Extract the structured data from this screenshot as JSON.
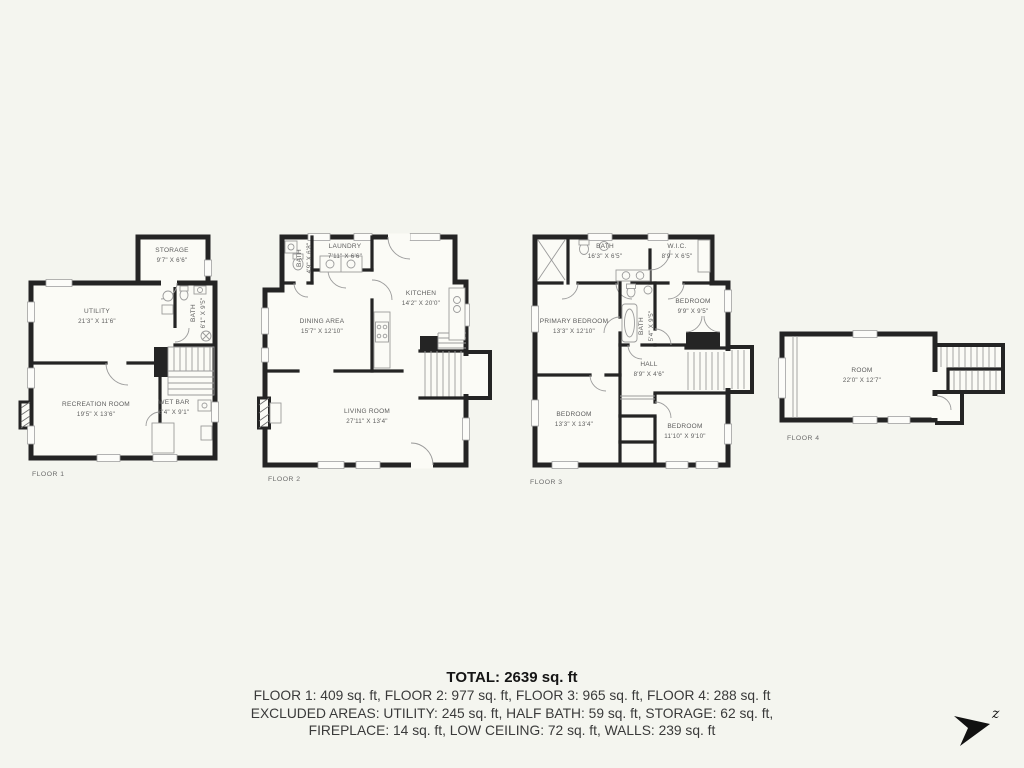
{
  "colors": {
    "background": "#f4f5ef",
    "walls": "#242424",
    "labels": "#5c5c5c"
  },
  "floors": [
    {
      "caption": "FLOOR 1",
      "rooms": [
        {
          "name": "STORAGE",
          "dims": "9'7\" X 6'6\""
        },
        {
          "name": "UTILITY",
          "dims": "21'3\" X 11'6\""
        },
        {
          "name": "BATH",
          "dims": "6'1\" X 9'5\""
        },
        {
          "name": "RECREATION ROOM",
          "dims": "19'5\" X 13'6\""
        },
        {
          "name": "WET BAR",
          "dims": "8'4\" X 9'1\""
        }
      ]
    },
    {
      "caption": "FLOOR 2",
      "rooms": [
        {
          "name": "LAUNDRY",
          "dims": "7'11\" X 6'6\""
        },
        {
          "name": "BATH",
          "dims": "4'9\" X 6'8\""
        },
        {
          "name": "KITCHEN",
          "dims": "14'2\" X 20'0\""
        },
        {
          "name": "DINING AREA",
          "dims": "15'7\" X 12'10\""
        },
        {
          "name": "LIVING ROOM",
          "dims": "27'11\" X 13'4\""
        }
      ]
    },
    {
      "caption": "FLOOR 3",
      "rooms": [
        {
          "name": "BATH",
          "dims": "16'3\" X 6'5\""
        },
        {
          "name": "W.I.C.",
          "dims": "8'9\" X 6'5\""
        },
        {
          "name": "PRIMARY BEDROOM",
          "dims": "13'3\" X 12'10\""
        },
        {
          "name": "BEDROOM",
          "dims": "9'9\" X 9'5\""
        },
        {
          "name": "BATH",
          "dims": "5'4\" X 9'5\""
        },
        {
          "name": "HALL",
          "dims": "8'9\" X 4'6\""
        },
        {
          "name": "BEDROOM",
          "dims": "13'3\" X 13'4\""
        },
        {
          "name": "BEDROOM",
          "dims": "11'10\" X 9'10\""
        }
      ]
    },
    {
      "caption": "FLOOR 4",
      "rooms": [
        {
          "name": "ROOM",
          "dims": "22'0\" X 12'7\""
        }
      ]
    }
  ],
  "summary": {
    "total": "TOTAL: 2639 sq. ft",
    "floors_line": "FLOOR 1: 409 sq. ft, FLOOR 2: 977 sq. ft, FLOOR 3: 965 sq. ft, FLOOR 4: 288 sq. ft",
    "excluded_line_1": "EXCLUDED AREAS: UTILITY: 245 sq. ft, HALF BATH: 59 sq. ft, STORAGE: 62 sq. ft,",
    "excluded_line_2": "FIREPLACE: 14 sq. ft, LOW CEILING: 72 sq. ft, WALLS: 239 sq. ft"
  },
  "compass": {
    "north_label": "z"
  }
}
